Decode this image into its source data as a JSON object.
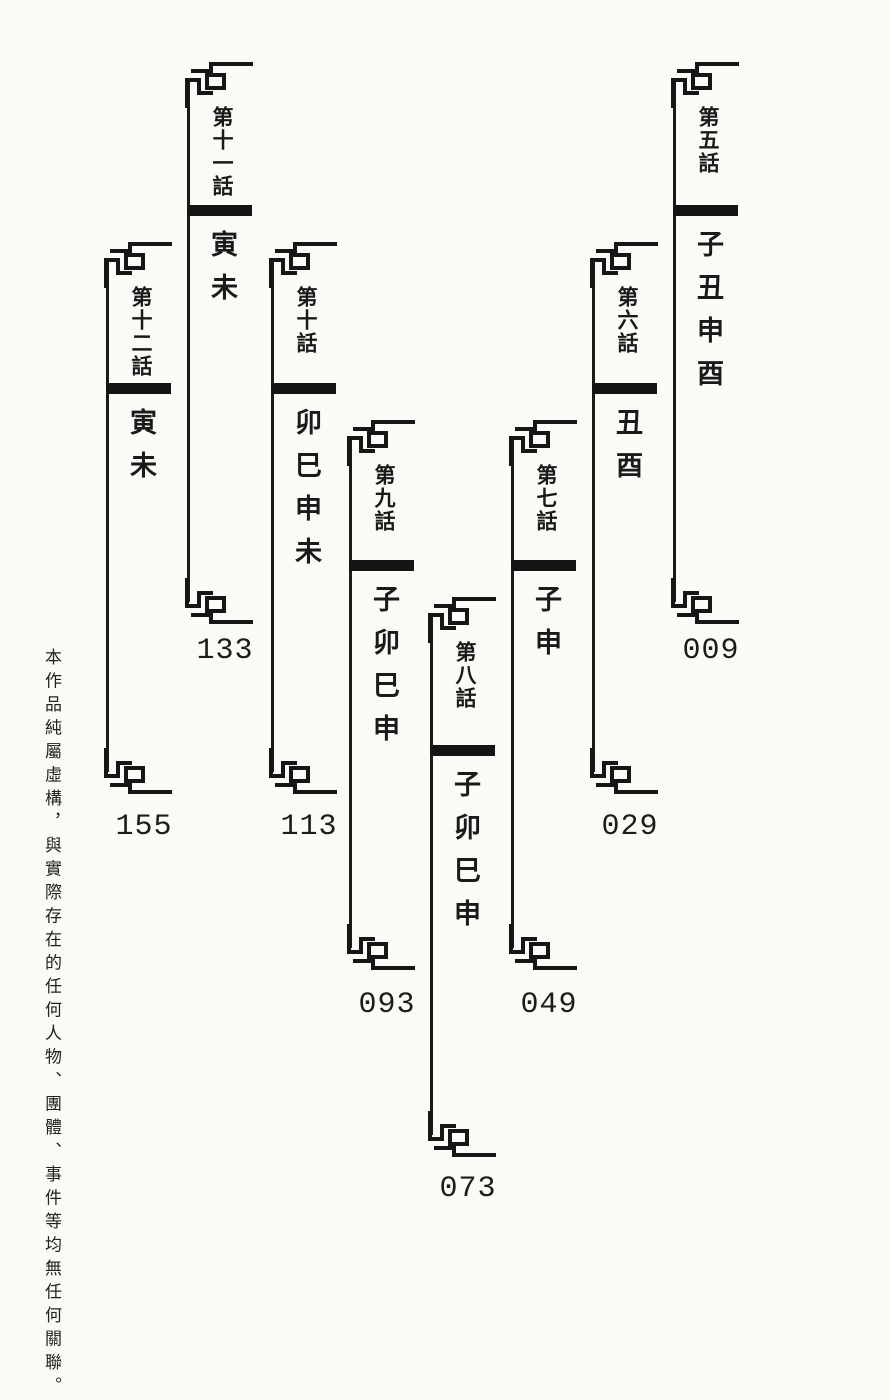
{
  "page": {
    "background": "#fbfaf6",
    "ink": "#1a1a1a"
  },
  "disclaimer": "本作品純屬虛構，與實際存在的任何人物、團體、事件等均無任何關聯。",
  "entries": [
    {
      "chapter": "第十二話",
      "title": "寅未",
      "page_number": "155"
    },
    {
      "chapter": "第十一話",
      "title": "寅未",
      "page_number": "133"
    },
    {
      "chapter": "第十話",
      "title": "卯巳申未",
      "page_number": "113"
    },
    {
      "chapter": "第九話",
      "title": "子卯巳申",
      "page_number": "093"
    },
    {
      "chapter": "第八話",
      "title": "子卯巳申",
      "page_number": "073"
    },
    {
      "chapter": "第七話",
      "title": "子申",
      "page_number": "049"
    },
    {
      "chapter": "第六話",
      "title": "丑酉",
      "page_number": "029"
    },
    {
      "chapter": "第五話",
      "title": "子丑申酉",
      "page_number": "009"
    }
  ]
}
